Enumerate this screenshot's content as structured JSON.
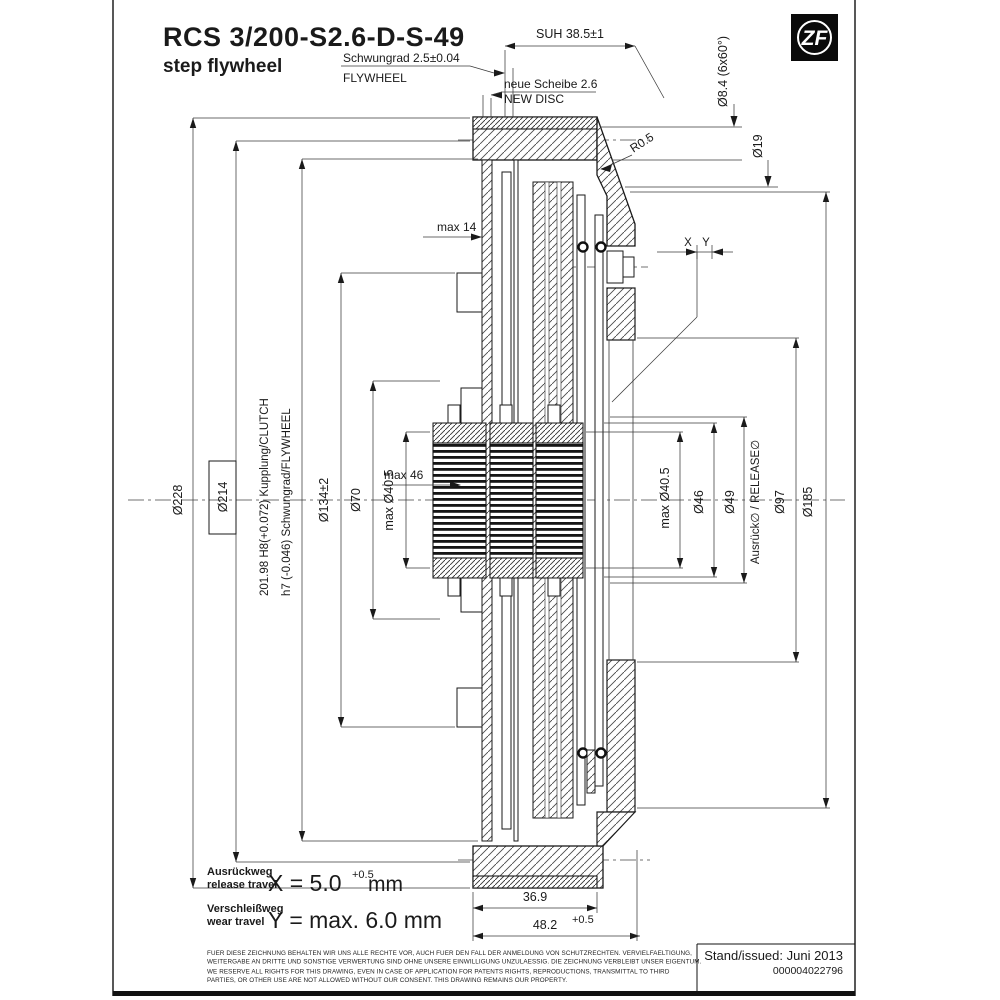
{
  "brand": {
    "logo_text": "ZF"
  },
  "title": {
    "model": "RCS 3/200-S2.6-D-S-49",
    "subtitle": "step flywheel"
  },
  "top": {
    "suh": "SUH 38.5±1",
    "flywheel_de": "Schwungrad 2.5±0.04",
    "flywheel_en": "FLYWHEEL",
    "disc_de": "neue Scheibe 2.6",
    "disc_en": "NEW DISC",
    "radius": "R0.5",
    "bolt_hole": "Ø8.4 (6x60°)",
    "bolt_pilot": "Ø19",
    "max_depth": "max 14",
    "x": "X",
    "y": "Y"
  },
  "left": {
    "d228": "Ø228",
    "d214": "Ø214",
    "fit_clutch": "201.98 H8(+0.072)  Kupplung/CLUTCH",
    "fit_flywheel": "h7 (-0.046)  Schwungrad/FLYWHEEL",
    "d134": "Ø134±2",
    "d70": "Ø70",
    "d40_5": "max Ø40.5",
    "max46": "max 46"
  },
  "right": {
    "d40_5": "max Ø40.5",
    "d46": "Ø46",
    "d49": "Ø49",
    "release": "Ausrück∅ / RELEASE∅",
    "d97": "Ø97",
    "d185": "Ø185"
  },
  "bottom": {
    "w_flywheel": "36.9",
    "w_total": "48.2",
    "w_total_tol": "+0.5"
  },
  "travel": {
    "release_de": "Ausrückweg",
    "release_en": "release travel",
    "release_val": "X = 5.0",
    "release_tol": "+0.5",
    "release_unit": "mm",
    "wear_de": "Verschleißweg",
    "wear_en": "wear travel",
    "wear_val": "Y = max. 6.0 mm"
  },
  "footer": {
    "de1": "FUER DIESE ZEICHNUNG BEHALTEN WIR UNS ALLE RECHTE VOR, AUCH FUER DEN FALL DER ANMELDUNG VON SCHUTZRECHTEN. VERVIELFAELTIGUNG,",
    "de2": "WEITERGABE AN DRITTE UND SONSTIGE VERWERTUNG SIND OHNE UNSERE EINWILLIGUNG UNZULAESSIG. DIE ZEICHNUNG VERBLEIBT UNSER EIGENTUM.",
    "en1": "WE RESERVE ALL RIGHTS FOR THIS DRAWING, EVEN IN CASE OF APPLICATION FOR PATENTS RIGHTS, REPRODUCTIONS, TRANSMITTAL TO THIRD",
    "en2": "PARTIES, OR OTHER USE ARE NOT ALLOWED WITHOUT OUR CONSENT. THIS DRAWING REMAINS OUR PROPERTY.",
    "issued": "Stand/issued: Juni 2013",
    "doc_number": "000004022796"
  }
}
